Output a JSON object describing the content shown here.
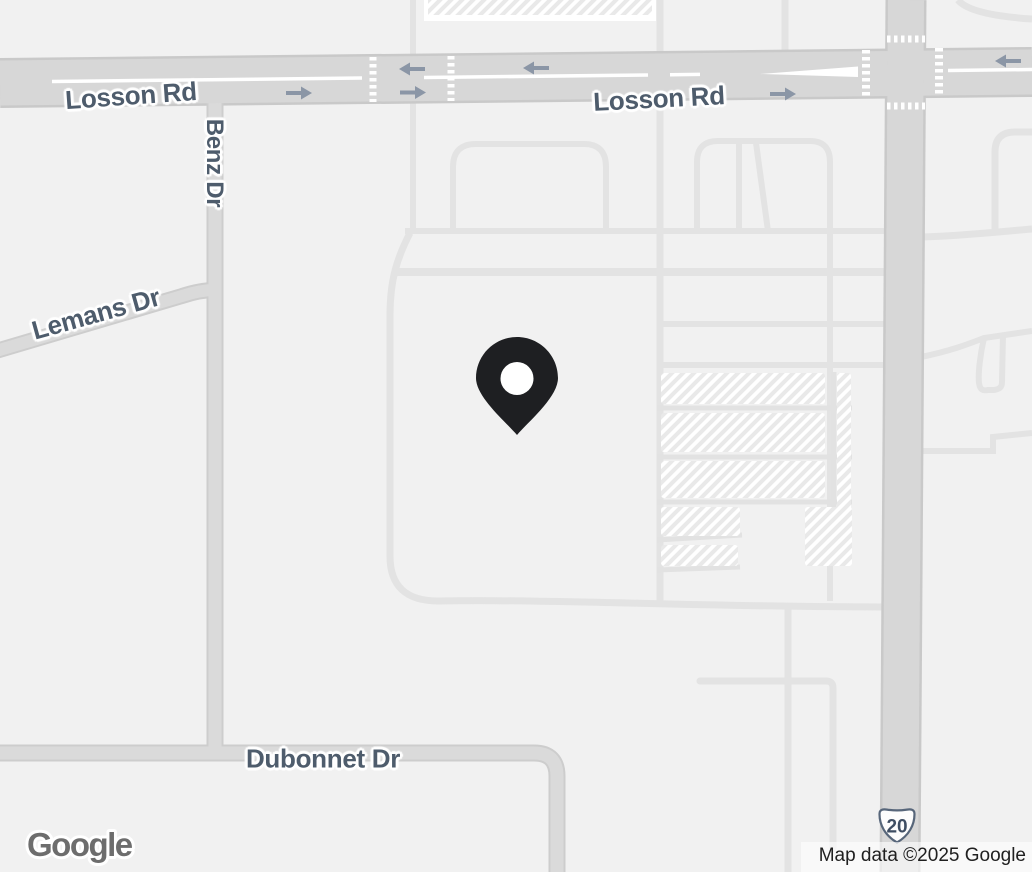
{
  "map": {
    "background_color": "#f1f1f1",
    "road_labels": {
      "losson_rd_west": "Losson Rd",
      "losson_rd_east": "Losson Rd",
      "benz_dr": "Benz Dr",
      "lemans_dr": "Lemans Dr",
      "dubonnet_dr": "Dubonnet Dr"
    },
    "route_shield": {
      "type": "us-route-shield",
      "number": "20"
    },
    "marker": {
      "icon": "map-pin",
      "color": "#1e1f22"
    },
    "direction_arrows": {
      "icons": [
        "arrow-left-icon",
        "arrow-right-icon"
      ],
      "color": "#8b96a6"
    },
    "footer": {
      "logo_text": "Google",
      "attribution_text": "Map data ©2025 Google"
    },
    "palette": {
      "road_major_fill": "#d7d7d7",
      "road_major_casing": "#c9c9c9",
      "road_minor": "#e3e3e3",
      "parking_lane": "#e2e2e2",
      "hatch_stripe": "#e9e9e9",
      "label_text": "#4e5c6c",
      "shield_outline": "#57667a",
      "crosswalk": "#ffffff"
    }
  }
}
